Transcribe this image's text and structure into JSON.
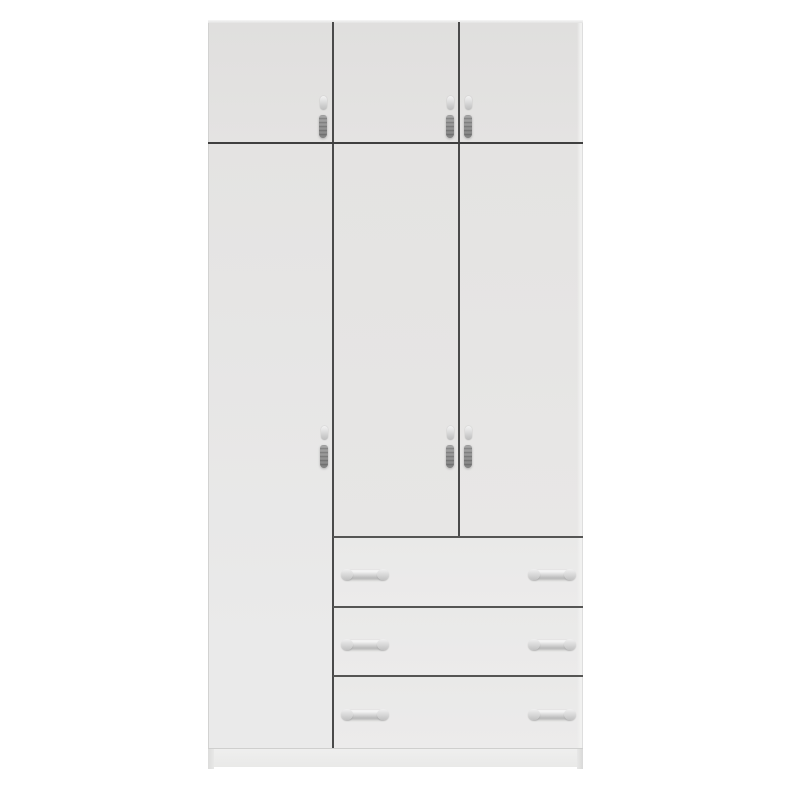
{
  "photo": {
    "subject": "White wardrobe with overhead storage cabinets, three doors and three drawers",
    "alt": "Tall white wardrobe: three overhead cabinet doors across the top, one full-height door on the left, two doors in the center and right, and three drawers at the bottom right; all doors and drawers have small silver handles; recessed plinth base at the bottom"
  },
  "wardrobe": {
    "finish": "white",
    "handle_finish": "silver",
    "overhead_cabinet_doors": 3,
    "full_height_doors": 1,
    "center_right_doors": 2,
    "drawers": 3,
    "vertical_door_handles": 6,
    "horizontal_drawer_handles": 6
  },
  "colors": {
    "background": "#ffffff",
    "body": "#e4e3e2",
    "body_dark": "#e0dfde",
    "body_light": "#eaeaea",
    "drawer": "#e9e9e8",
    "seam": "#4a4a4a",
    "seam_soft": "#555554",
    "handle": "#bdbdbd",
    "handle_hi": "#f3f3f3",
    "handle_dark": "#9c9c9c"
  }
}
